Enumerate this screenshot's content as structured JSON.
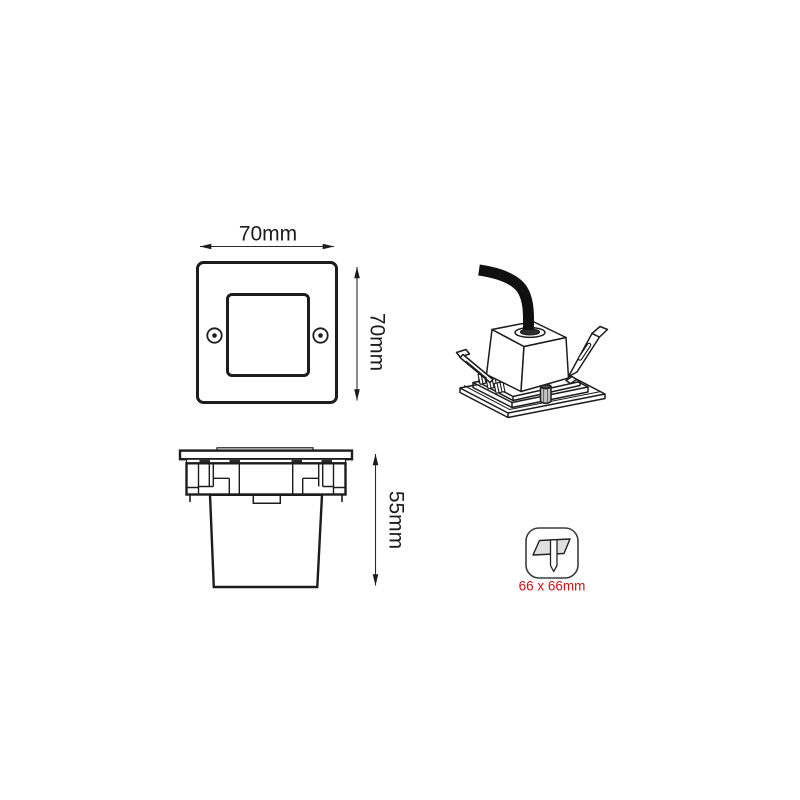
{
  "views": {
    "front": {
      "width_label": "70mm",
      "height_label": "70mm"
    },
    "side": {
      "depth_label": "55mm"
    },
    "cutout": {
      "size_label": "66 x 66mm"
    }
  },
  "icons": {
    "cutout_icon": "ceiling-cutout-symbol"
  },
  "colors": {
    "line": "#1c1c1c",
    "dimension_line": "#2a2a2a",
    "cable": "#101010",
    "cutout_text": "#cc1414",
    "cutout_panel_fill": "#e0e0e0",
    "cutout_icon_border": "#3d3d3d",
    "background": "#ffffff"
  }
}
